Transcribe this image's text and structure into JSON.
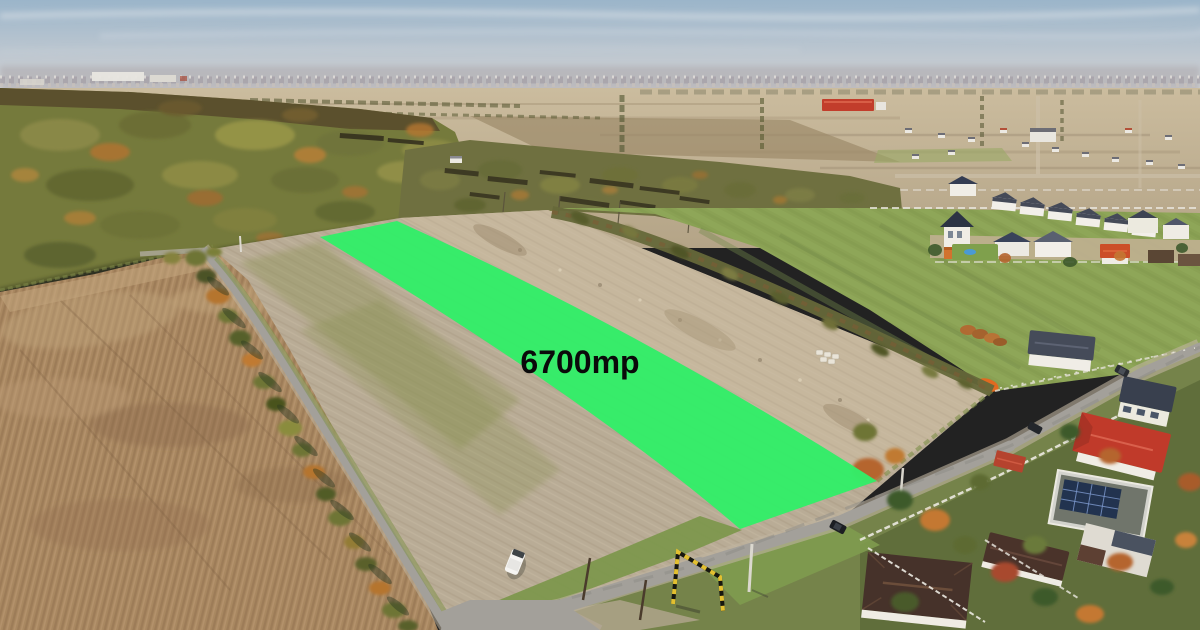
{
  "overlay": {
    "area_label": "6700mp",
    "highlight_color": "#33ED68",
    "label_color": "#0a0a0a"
  },
  "palette": {
    "sky_top": "#9bb5ca",
    "sky_mid": "#c3cad1",
    "sky_horizon": "#d9dad8",
    "town_haze": "#a49da1",
    "far_fields_light": "#cbbc9e",
    "far_fields_dark": "#b4a487",
    "forest": "#757a3c",
    "forest_top": "#57492a",
    "scrub": "#6f7040",
    "plowed_field": "#a98861",
    "parcel_stubble": "#b9ac96",
    "parcel_dirt": "#c6b79d",
    "green_field": "#8aa154",
    "grass_verge": "#7d974d",
    "road_asphalt": "#a3a09a",
    "road_shoulder": "#c0b4a0",
    "wall_white": "#f2efe9",
    "roof_dark": "#454a58",
    "roof_red": "#c03a2a",
    "roof_brown": "#46322a",
    "roof_terracotta": "#d2722e",
    "solar_panel": "#22334f",
    "gate_black": "#17170f",
    "gate_yellow": "#e3c030",
    "van_white": "#f6f5f2",
    "warehouse_red": "#c23d2b"
  }
}
